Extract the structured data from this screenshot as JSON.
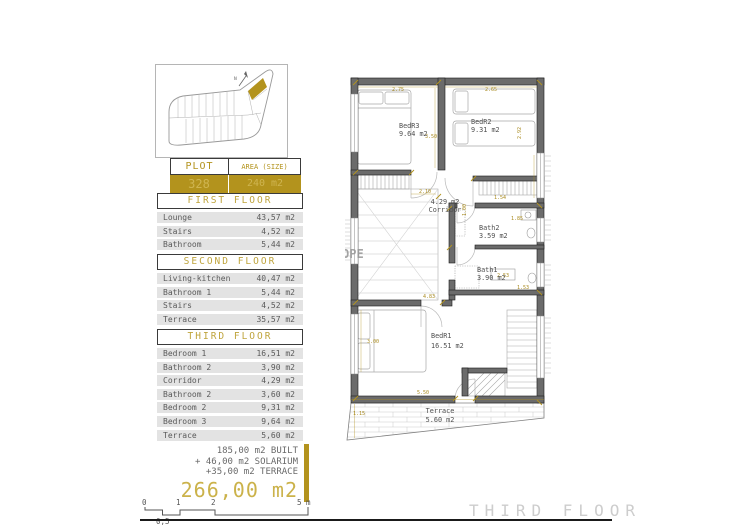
{
  "plot_map": {
    "north_label": "N"
  },
  "plot_table": {
    "header_plot": "PLOT",
    "header_area": "AREA (SIZE)",
    "plot_number": "328",
    "plot_area": "240 m2"
  },
  "floors": [
    {
      "title": "FIRST FLOOR",
      "rows": [
        {
          "label": "Lounge",
          "value": "43,57 m2"
        },
        {
          "label": "Stairs",
          "value": "4,52 m2"
        },
        {
          "label": "Bathroom",
          "value": "5,44 m2"
        }
      ]
    },
    {
      "title": "SECOND FLOOR",
      "rows": [
        {
          "label": "Living-kitchen",
          "value": "40,47 m2"
        },
        {
          "label": "Bathroom 1",
          "value": "5,44 m2"
        },
        {
          "label": "Stairs",
          "value": "4,52 m2"
        },
        {
          "label": "Terrace",
          "value": "35,57 m2"
        }
      ]
    },
    {
      "title": "THIRD FLOOR",
      "rows": [
        {
          "label": "Bedroom 1",
          "value": "16,51 m2"
        },
        {
          "label": "Bathroom 2",
          "value": "3,90 m2"
        },
        {
          "label": "Corridor",
          "value": "4,29 m2"
        },
        {
          "label": "Bathroom 2",
          "value": "3,60 m2"
        },
        {
          "label": "Bedroom 2",
          "value": "9,31 m2"
        },
        {
          "label": "Bedroom 3",
          "value": "9,64 m2"
        },
        {
          "label": "Terrace",
          "value": "5,60 m2"
        }
      ]
    }
  ],
  "summary": {
    "line1": "185,00 m2 BUILT",
    "line2": "+ 46,00 m2 SOLARIUM",
    "line3": "+35,00 m2 TERRACE",
    "total": "266,00 m2"
  },
  "scale_bar": {
    "tick0": "0",
    "tick1": "1",
    "tick2": "2",
    "tick5": "5 m",
    "half": "0,5"
  },
  "floor_plan": {
    "rooms": {
      "bedr3": {
        "name": "BedR3",
        "area": "9.64 m2"
      },
      "bedr2": {
        "name": "BedR2",
        "area": "9.31 m2"
      },
      "corridor": {
        "area": "4.29 m2",
        "name": "Corridor"
      },
      "bath2": {
        "name": "Bath2",
        "area": "3.59 m2"
      },
      "bath1": {
        "name": "Bath1",
        "area": "3.90 m2"
      },
      "bedr1": {
        "name": "BedR1",
        "area": "16.51 m2"
      },
      "terrace": {
        "name": "Terrace",
        "area": "5.60 m2"
      }
    },
    "dims": {
      "bedr3_w": "2.75",
      "bedr2_w": "2.65",
      "bedr3_h": "3.50",
      "bedr2_h": "2.92",
      "corridor_w": "2.10",
      "corridor_h": "1.00",
      "bath2_w": "1.54",
      "bath2_h": "1.85",
      "vanity": "2.53",
      "bath1_h": "1.53",
      "bedr1_w": "4.83",
      "bedr1_h": "3.00",
      "terrace_w": "5.50",
      "terrace_h": "1.15"
    },
    "watermark": "OPE",
    "footer": "THIRD FLOOR"
  },
  "colors": {
    "gold": "#b3931d",
    "gold_light": "#cfb551",
    "wall": "#6b6b6b",
    "row_bg": "#e3e3e3"
  }
}
